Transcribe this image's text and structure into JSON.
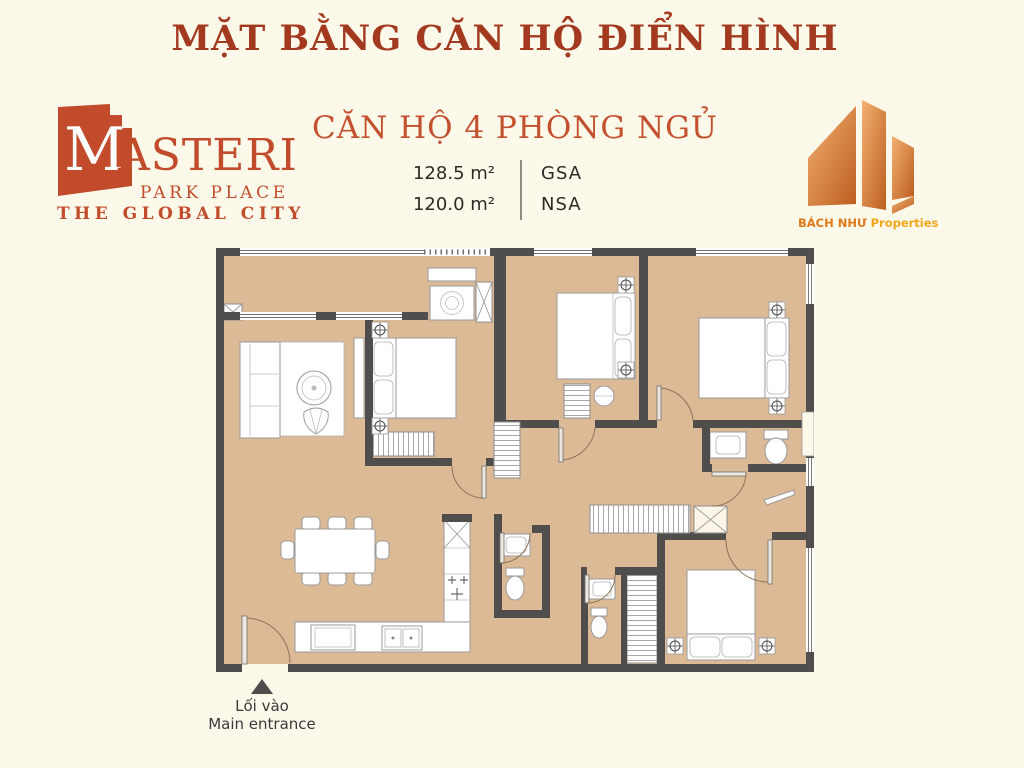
{
  "page": {
    "title": "MẶT BẰNG CĂN HỘ ĐIỂN HÌNH"
  },
  "colors": {
    "background": "#FCF8EA",
    "title": "#A33A1F",
    "accent": "#C14B2B",
    "subtitle": "#C4512D",
    "floor": "#DCBA96",
    "wall": "#4F4E4C",
    "text_dark": "#2E2A26",
    "bachnhu_name": "#E07A18",
    "bachnhu_suffix": "#F2A71B"
  },
  "masteri_logo": {
    "brand_initial": "M",
    "brand_rest": "ASTERI",
    "line2": "PARK PLACE",
    "line3": "THE GLOBAL CITY"
  },
  "apartment": {
    "title": "CĂN HỘ 4 PHÒNG NGỦ",
    "areas": [
      {
        "value": "128.5 m²",
        "label": "GSA"
      },
      {
        "value": "120.0 m²",
        "label": "NSA"
      }
    ]
  },
  "bachnhu_logo": {
    "name": "BÁCH NHƯ",
    "suffix": "Properties"
  },
  "entrance": {
    "label_vi": "Lối vào",
    "label_en": "Main entrance"
  }
}
